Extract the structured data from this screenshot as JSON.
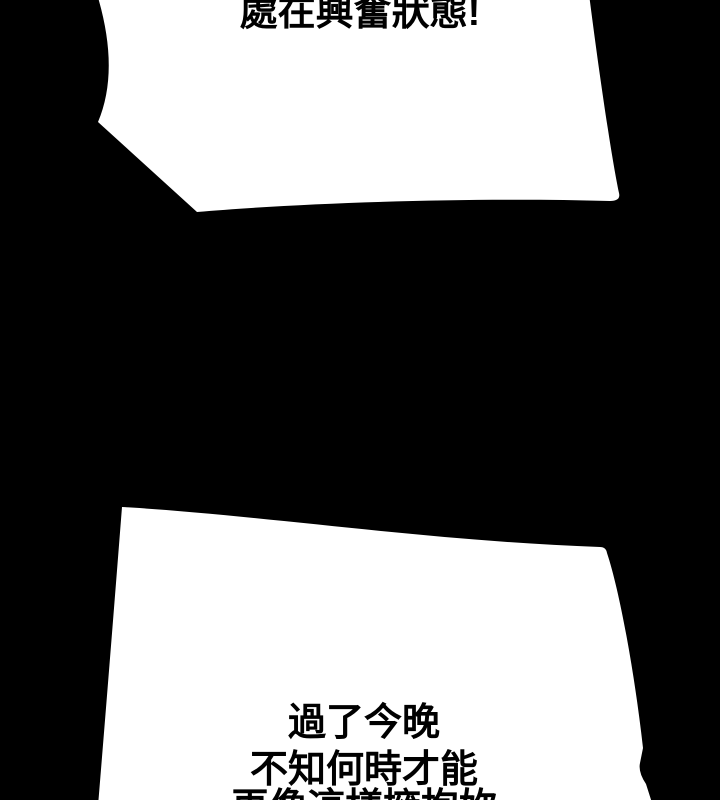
{
  "colors": {
    "background": "#000000",
    "bubble_fill": "#ffffff",
    "text": "#000000"
  },
  "panel": {
    "type": "comic-page-fragment",
    "top_bubble": {
      "text": "處在興奮狀態!",
      "note_visible_state": "text clipped at top edge of viewport"
    },
    "bottom_bubble": {
      "lines": [
        "過了今晚",
        "不知何時才能",
        "再像這樣擁抱妳"
      ]
    }
  }
}
